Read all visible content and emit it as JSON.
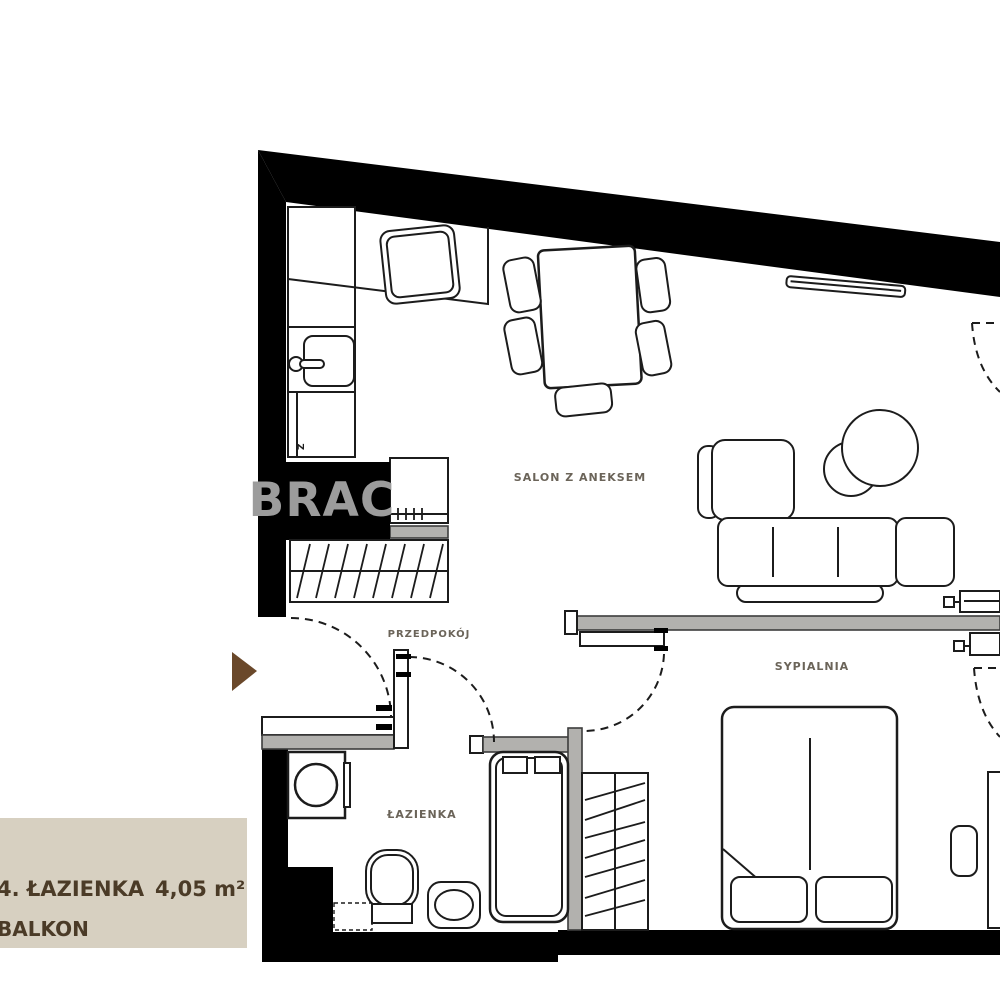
{
  "watermark": {
    "text": "BRAC",
    "color": "#9c9c9c",
    "box_color": "#000000"
  },
  "rooms": {
    "salon": "SALON Z ANEKSEM",
    "bedroom": "SYPIALNIA",
    "hallway": "PRZEDPOKÓJ",
    "bathroom": "ŁAZIENKA"
  },
  "kitchen": {
    "dishwasher_label": "Z"
  },
  "legend": {
    "row1_label": "4. ŁAZIENKA",
    "row1_area": "4,05 m²",
    "row2_label": "BALKON",
    "panel_color": "#d7d0c1",
    "text_color": "#4b3b27"
  },
  "entrance_marker_color": "#6a482a",
  "colors": {
    "wall": "#000000",
    "partition": "#b2b1ae",
    "line": "#1c1c1c",
    "room_label": "#6b6459"
  }
}
